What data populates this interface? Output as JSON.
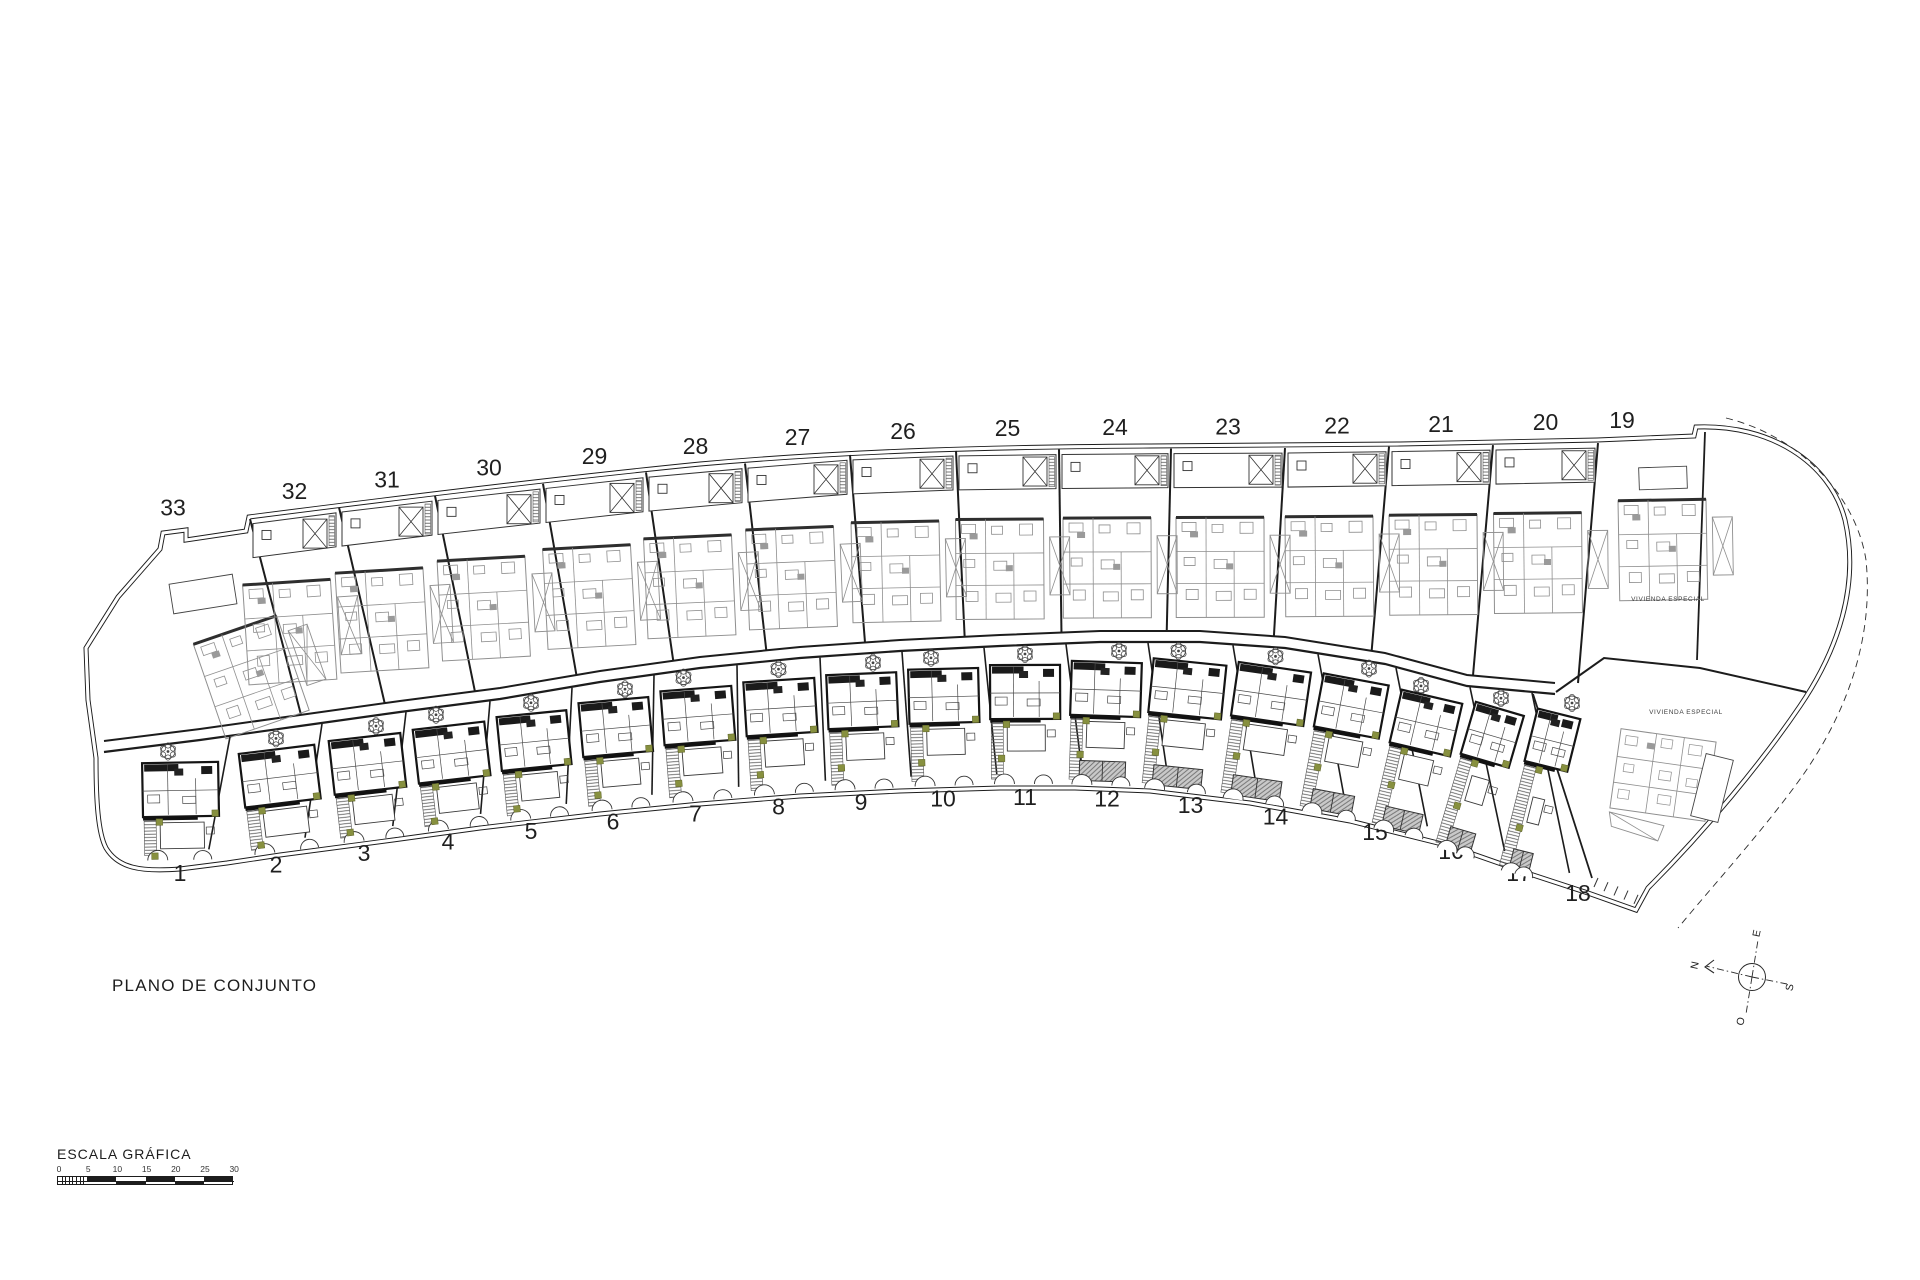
{
  "drawing": {
    "title": "PLANO DE CONJUNTO",
    "scale_bar": {
      "title": "ESCALA GRÁFICA",
      "tick_labels": [
        "0",
        "5",
        "10",
        "15",
        "20",
        "25",
        "30"
      ]
    },
    "compass": {
      "north": "N",
      "south": "S",
      "east": "E",
      "west": "O"
    },
    "plot_rows": {
      "top": {
        "numbers": [
          "33",
          "32",
          "31",
          "30",
          "29",
          "28",
          "27",
          "26",
          "25",
          "24",
          "23",
          "22",
          "21",
          "20",
          "19"
        ]
      },
      "bottom": {
        "numbers": [
          "1",
          "2",
          "3",
          "4",
          "5",
          "6",
          "7",
          "8",
          "9",
          "10",
          "11",
          "12",
          "13",
          "14",
          "15",
          "16",
          "17",
          "18"
        ]
      }
    },
    "special_plots": [
      {
        "label": "VIVIENDA ESPECIAL"
      },
      {
        "label": "VIVIENDA ESPECIAL"
      }
    ],
    "colors": {
      "ink": "#1c1c1c",
      "ghost": "#8f8f8f",
      "olive": "#87903f",
      "hatch": "#8a8a8a"
    }
  }
}
